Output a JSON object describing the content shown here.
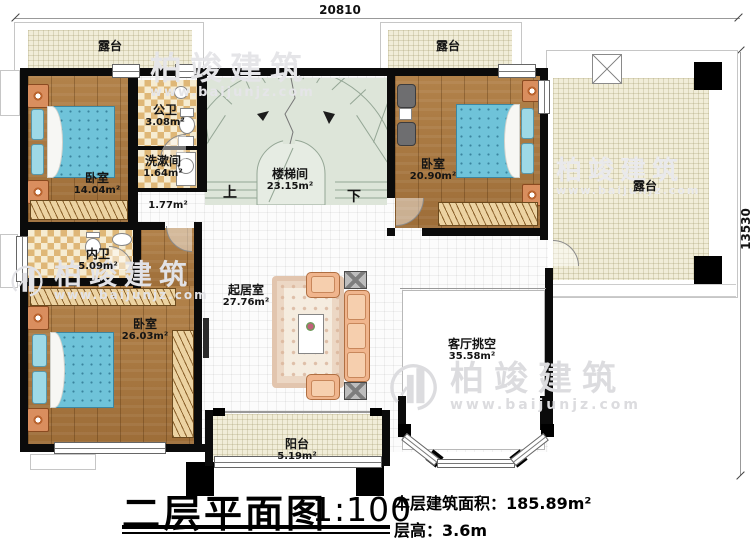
{
  "plan": {
    "type": "floor-plan",
    "floor": "second"
  },
  "rooms": {
    "terrace_top_left": {
      "name": "露台",
      "area": ""
    },
    "terrace_top_right": {
      "name": "露台",
      "area": ""
    },
    "terrace_right": {
      "name": "露台",
      "area": ""
    },
    "bedroom_top_left": {
      "name": "卧室",
      "area": "14.04m²"
    },
    "public_bath": {
      "name": "公卫",
      "area": "3.08m²"
    },
    "wash_room": {
      "name": "洗漱间",
      "area": "1.64m²"
    },
    "hallway": {
      "name": "",
      "area": "1.77m²"
    },
    "stair_hall": {
      "name": "楼梯间",
      "area": "23.15m²"
    },
    "bedroom_top_right": {
      "name": "卧室",
      "area": "20.90m²"
    },
    "ensuite_bath": {
      "name": "内卫",
      "area": "5.09m²"
    },
    "bedroom_bottom_left": {
      "name": "卧室",
      "area": "26.03m²"
    },
    "living_room": {
      "name": "起居室",
      "area": "27.76m²"
    },
    "living_void": {
      "name": "客厅挑空",
      "area": "35.58m²"
    },
    "balcony": {
      "name": "阳台",
      "area": "5.19m²"
    }
  },
  "stairs": {
    "up": "上",
    "down": "下"
  },
  "dimensions": {
    "top_width": "20810",
    "right_height": "13530"
  },
  "title_block": {
    "title": "二层平面图",
    "scale": "1:100",
    "floor_area": "本层建筑面积：185.89m²",
    "floor_height": "层高：3.6m"
  },
  "watermark": {
    "brand": "柏竣建筑",
    "url": "www.baijunjz.com"
  },
  "colors": {
    "wall": "#0b0b0b",
    "wood_floor": "#a9773f",
    "bed_blue": "#6fc3d9",
    "terrace_cream": "#f1edd8",
    "tile_checker": "#dfb777",
    "stair_green": "#dde5d9",
    "sofa_peach": "#f0b58d",
    "watermark_gray": "#e5e5e8"
  }
}
